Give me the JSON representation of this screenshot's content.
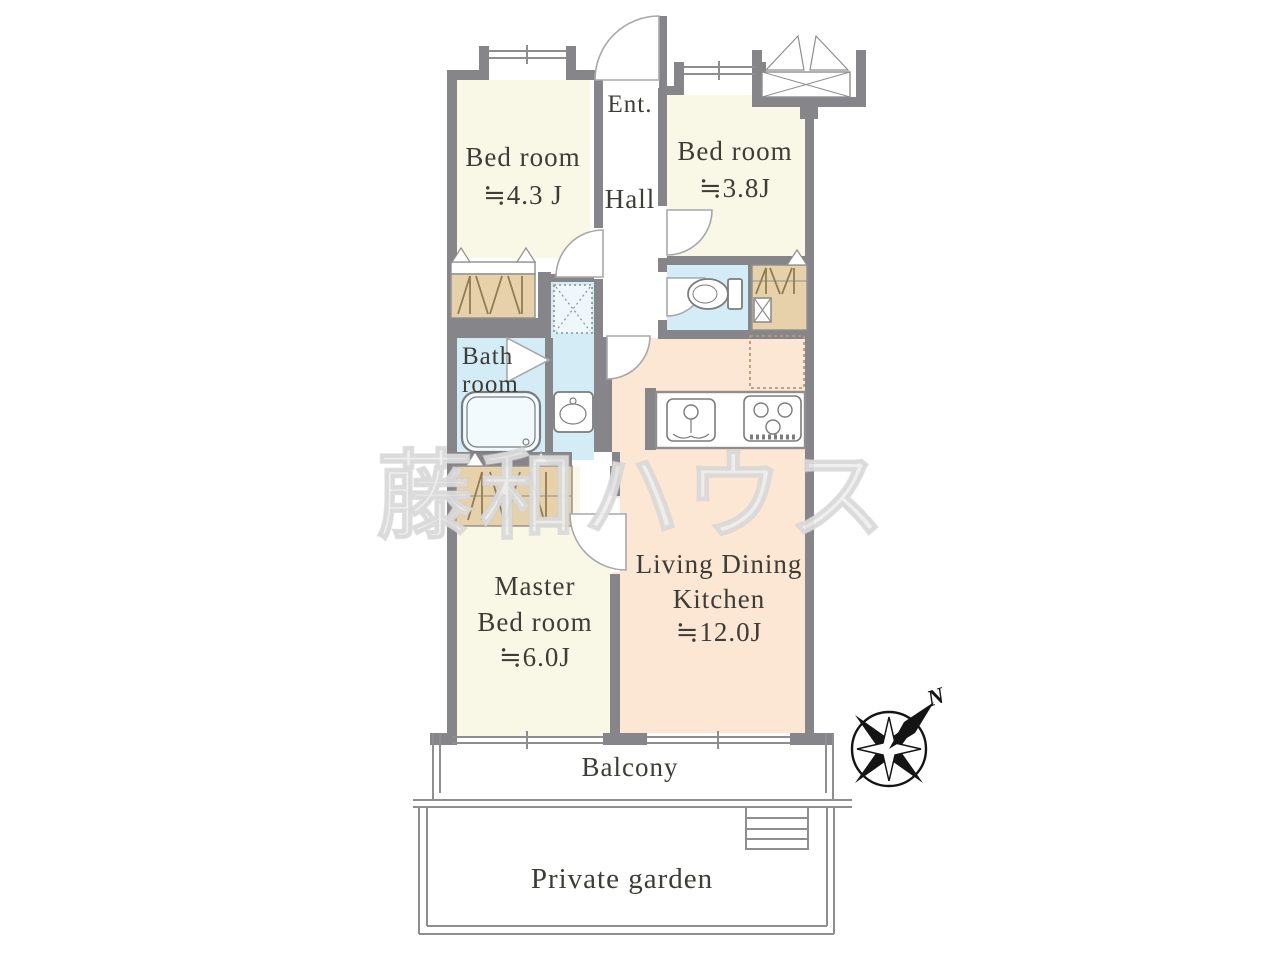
{
  "rooms": {
    "bedroom_top_left": {
      "name": "Bed room",
      "size": "≒4.3 J"
    },
    "bedroom_top_right": {
      "name": "Bed room",
      "size": "≒3.8J"
    },
    "entrance": {
      "label": "Ent."
    },
    "hall": {
      "label": "Hall"
    },
    "bathroom": {
      "name_line1": "Bath",
      "name_line2": "room"
    },
    "master_bedroom": {
      "name_line1": "Master",
      "name_line2": "Bed room",
      "size": "≒6.0J"
    },
    "living_dining_kitchen": {
      "name_line1": "Living Dining",
      "name_line2": "Kitchen",
      "size": "≒12.0J"
    },
    "balcony": {
      "label": "Balcony"
    },
    "private_garden": {
      "label": "Private garden"
    }
  },
  "compass": {
    "north_label": "N"
  },
  "watermark": {
    "text": "藤和ハウス"
  },
  "colors": {
    "wall": "#86868a",
    "room_cream": "#f9f7e6",
    "ldk_peach": "#fce6d4",
    "water_blue": "#d3ecf5",
    "pan_fill": "#eef7fb",
    "closet_tan": "#e6d1aa",
    "line_gray": "#8e8e8e",
    "hanger": "#8f7d52",
    "text": "#3d3d37",
    "watermark_fill": "#ededed",
    "compass_ink": "#141414"
  }
}
